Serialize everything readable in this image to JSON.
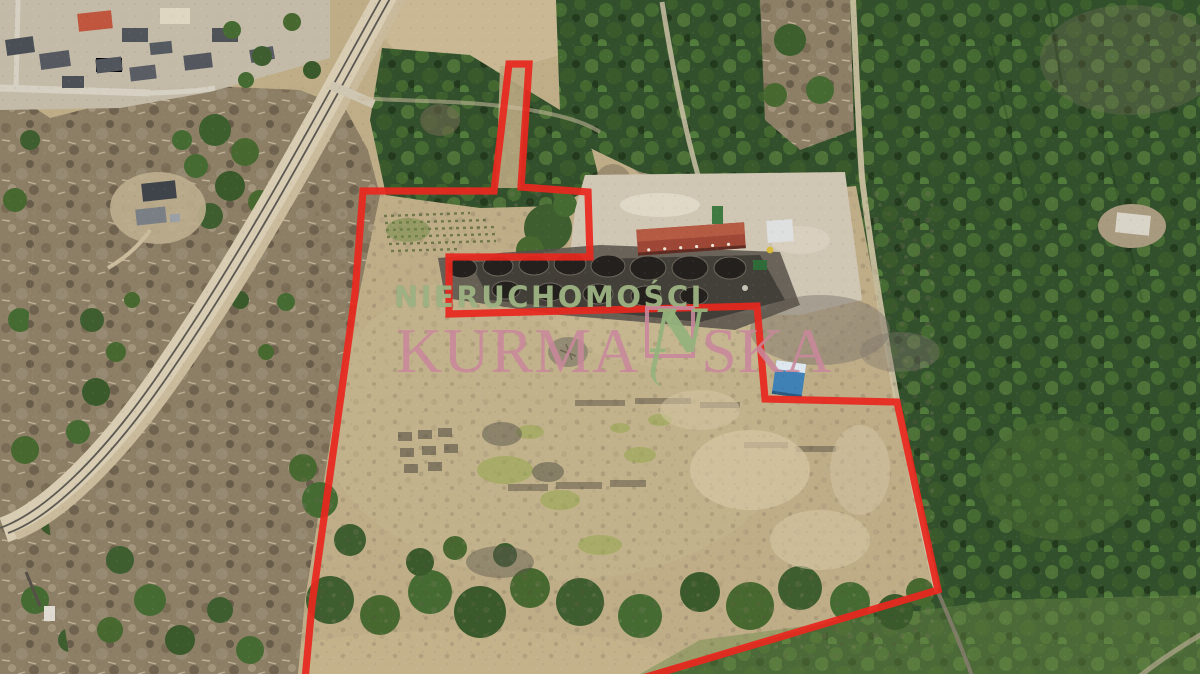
{
  "watermark": {
    "line1": "NIERUCHOMOŚCI",
    "brand_full": "KURMAŃSKA",
    "brand_prefix": "KURMA",
    "brand_n_letter": "N",
    "brand_suffix": "SKA",
    "colors": {
      "line1_green": "#9db283",
      "brand_pink": "#c8879b",
      "logo_green": "#95b27c"
    }
  },
  "boundary": {
    "description_color": "#e8281e",
    "color": "#e8281e",
    "points": "305,680 312,604 336,432 355,294 363,191 494,191 509,64 529,64 521,187 588,192 590,257 449,257 449,314 757,306 765,399 897,402 938,590 636,680"
  },
  "scene_colors": {
    "field_tan": "#bfad88",
    "forest_green_dark": "#32502c",
    "forest_brown": "#8d7f66",
    "charcoal": "#34302a",
    "rust_roof": "#a04838",
    "blue_roof": "#3f80b5",
    "railway": "#d8cdb2"
  }
}
